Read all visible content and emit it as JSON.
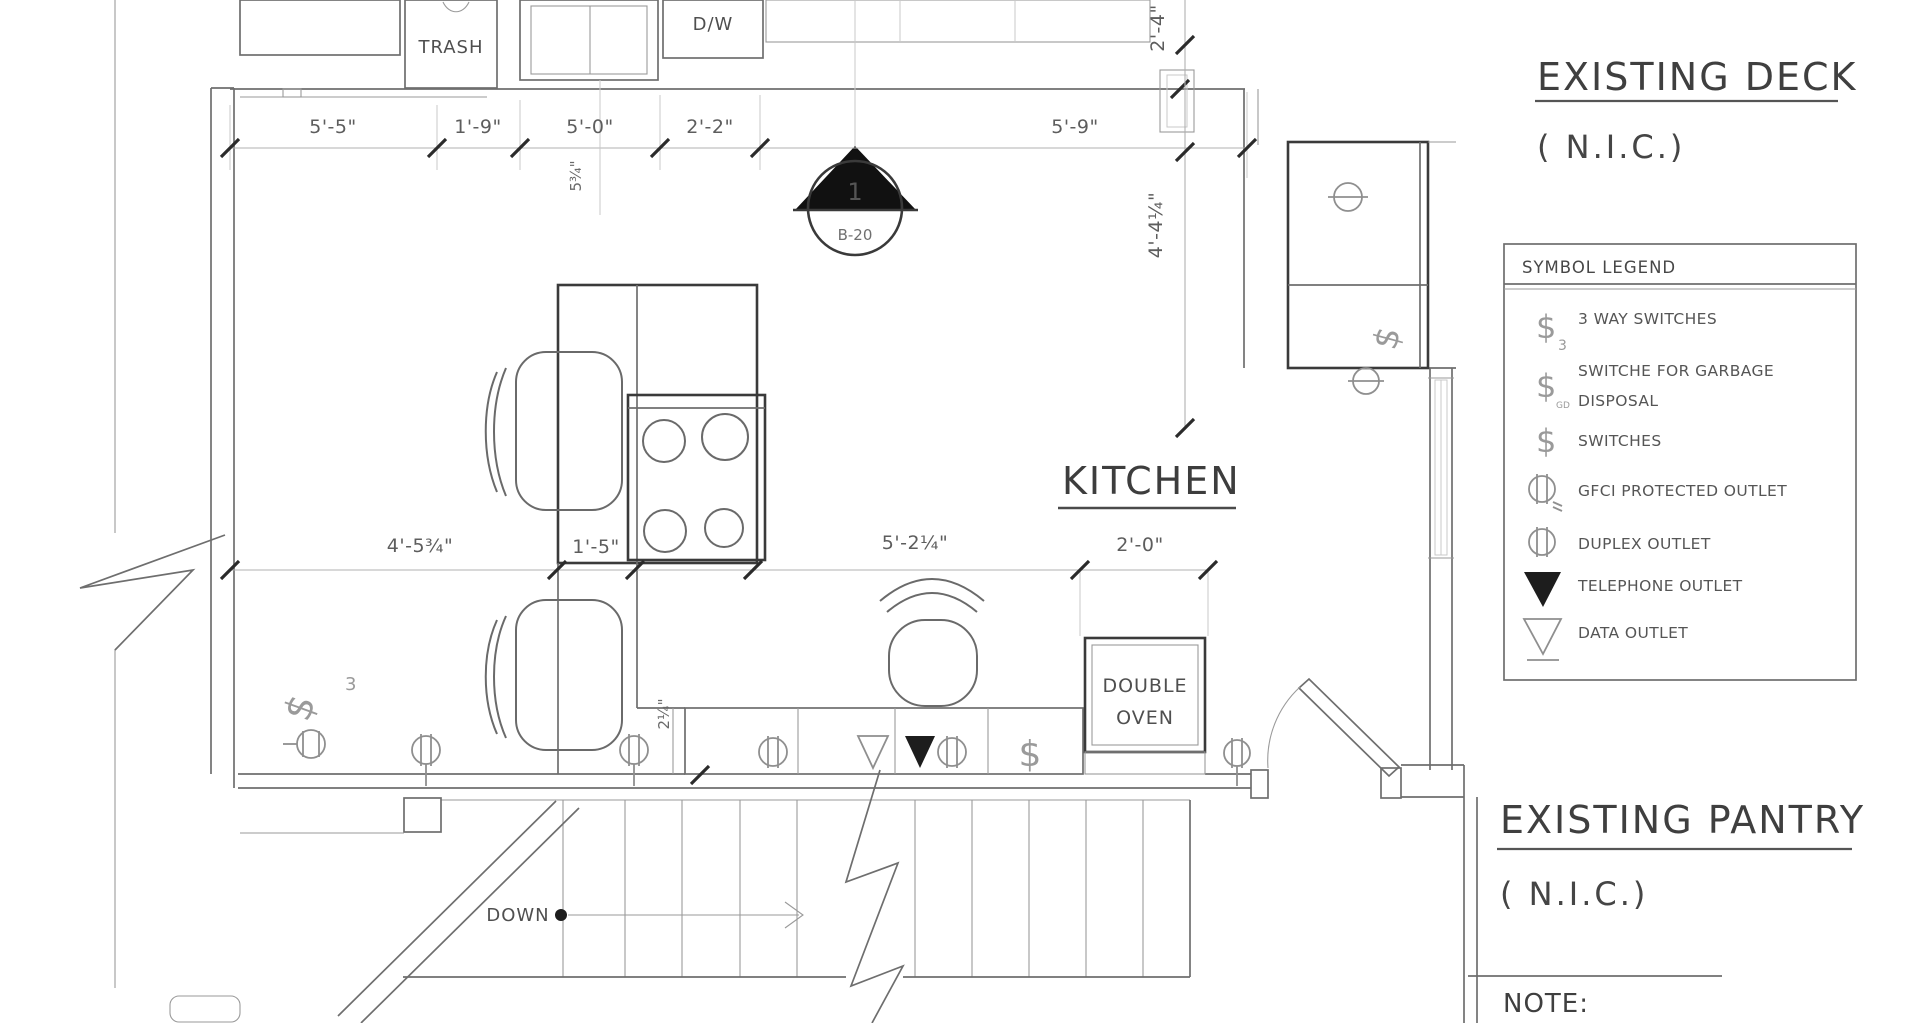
{
  "colors": {
    "background": "#ffffff",
    "wall_line": "#6e6e6e",
    "heavy_line": "#3a3a3a",
    "dimension_line": "#b0b0b0",
    "text": "#4a4a4a",
    "symbol_gray": "#9a9a9a",
    "filled_black": "#1d1d1d"
  },
  "labels": {
    "kitchen": "KITCHEN",
    "trash": "TRASH",
    "dishwasher": "D/W",
    "double_oven_line1": "DOUBLE",
    "double_oven_line2": "OVEN",
    "down": "DOWN",
    "note": "NOTE:",
    "deck_title": "EXISTING DECK",
    "deck_nic": "( N.I.C.)",
    "pantry_title": "EXISTING PANTRY",
    "pantry_nic": "( N.I.C.)"
  },
  "section_marker": {
    "number": "1",
    "reference": "B-20"
  },
  "dimensions": {
    "top": [
      "5'-5\"",
      "1'-9\"",
      "5'-0\"",
      "2'-2\"",
      "5'-9\""
    ],
    "middle": [
      "4'-5¾\"",
      "1'-5\"",
      "5'-2¼\"",
      "2'-0\""
    ],
    "vertical_right": [
      "2'-4\"",
      "4'-4¼\""
    ],
    "vertical_small": [
      "5¾\"",
      "2¼\""
    ]
  },
  "plan_symbols": {
    "switch": "$",
    "three_way_subscript": "3"
  },
  "legend": {
    "title": "SYMBOL LEGEND",
    "items": [
      {
        "symbol": "three-way-switch",
        "glyph": "$",
        "subscript": "3",
        "label": "3 WAY SWITCHES"
      },
      {
        "symbol": "garbage-disposal-switch",
        "glyph": "$",
        "subscript": "GD",
        "label": "SWITCHE FOR GARBAGE",
        "label2": "DISPOSAL"
      },
      {
        "symbol": "switch",
        "glyph": "$",
        "label": "SWITCHES"
      },
      {
        "symbol": "gfci-outlet",
        "label": "GFCI PROTECTED OUTLET"
      },
      {
        "symbol": "duplex-outlet",
        "label": "DUPLEX OUTLET"
      },
      {
        "symbol": "telephone-outlet",
        "label": "TELEPHONE OUTLET"
      },
      {
        "symbol": "data-outlet",
        "label": "DATA OUTLET"
      }
    ]
  }
}
